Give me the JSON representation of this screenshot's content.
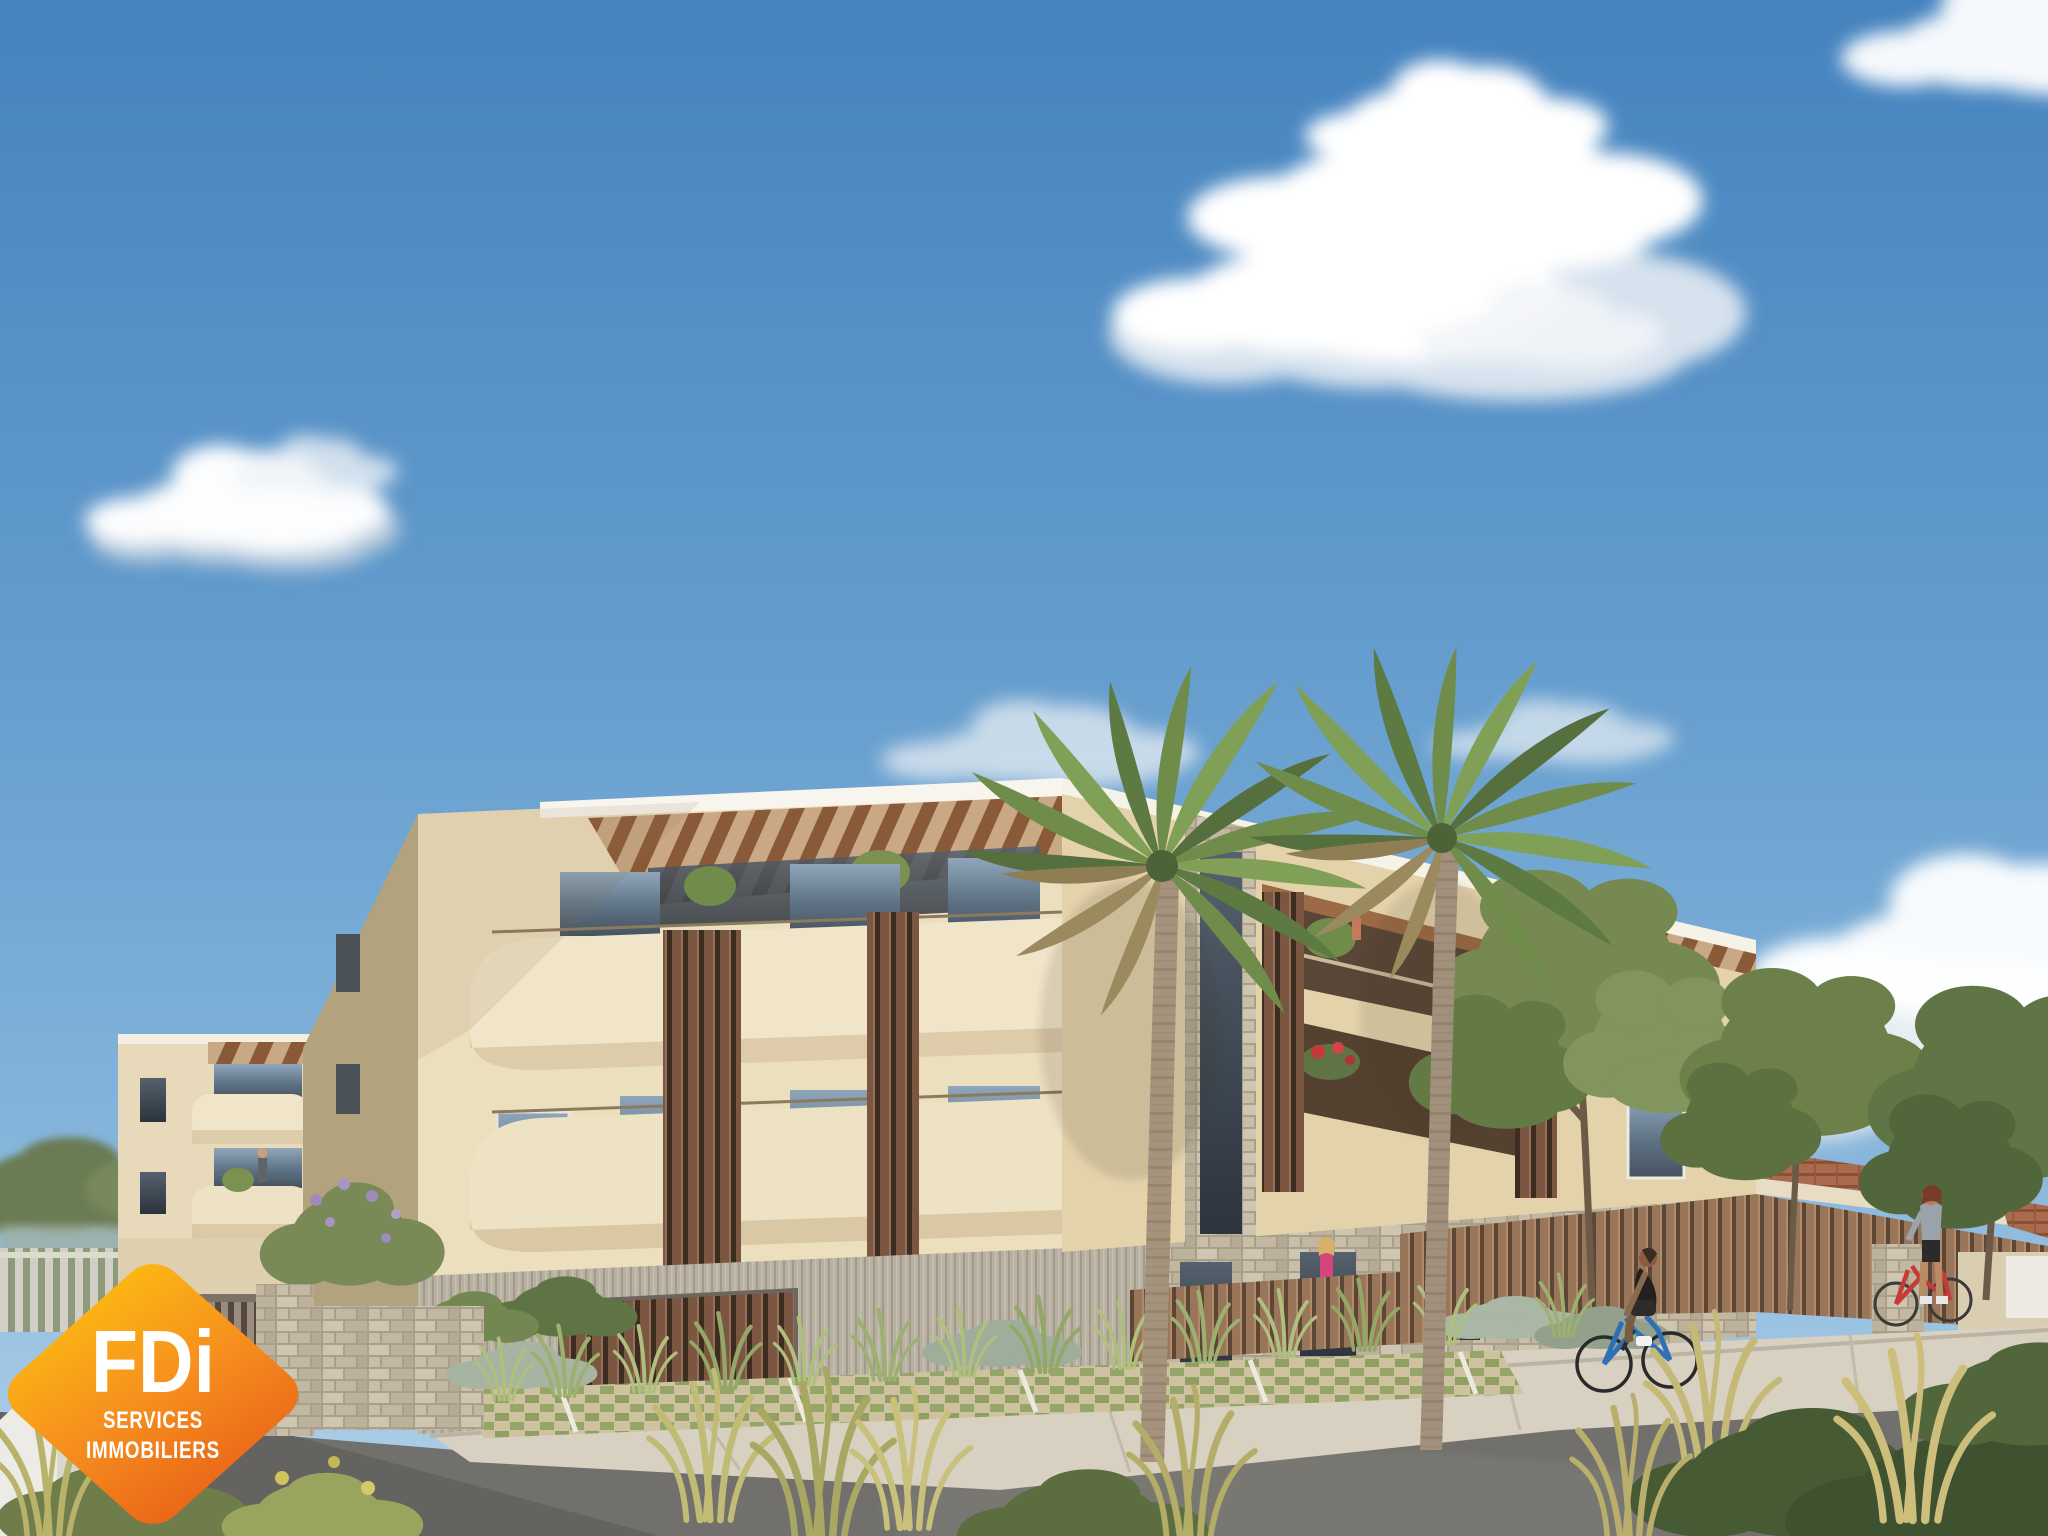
{
  "image": {
    "kind": "architectural-rendering",
    "subject": "modern three-storey cream apartment residence with rounded balconies, wood slat screens, rooftop pergolas, stone-clad base, two fan palms, landscaped street with cyclist and pedestrians under a blue sky with cumulus clouds",
    "width_px": 2048,
    "height_px": 1536
  },
  "logo": {
    "brand": "FDi",
    "line1": "SERVICES",
    "line2": "IMMOBILIERS",
    "shape": "rounded-diamond-badge",
    "gradient": [
      "#FCBB12",
      "#F68F1E",
      "#E96218"
    ],
    "text_color": "#FFFFFF"
  },
  "palette": {
    "sky_top": "#4583BF",
    "sky_horizon": "#AECFE8",
    "cloud_white": "#FFFFFF",
    "facade_cream": "#ECDFBE",
    "facade_shaded_side": "#B3A27E",
    "facade_right_block": "#E4D2AB",
    "balcony_parapet": "#F0E5C8",
    "wood_slats": "#7B5640",
    "pergola_wood": "#8A5A38",
    "stone_cladding": "#C6BDA9",
    "ground_cladding_grey": "#B8B1A2",
    "roof_tiles_terracotta": "#A96A4E",
    "asphalt": "#72706C",
    "sidewalk_concrete": "#D8D0C0",
    "paver_grass_green": "#96A568",
    "palm_frond_green": "#6F8C4A",
    "palm_trunk": "#A5937D",
    "tree_green": "#6D8049",
    "grass_yellow_green": "#C2BB76",
    "bicycle_blue": "#2F6FB5",
    "bicycle_red": "#C93A35",
    "outfit_pink": "#D6447E"
  }
}
